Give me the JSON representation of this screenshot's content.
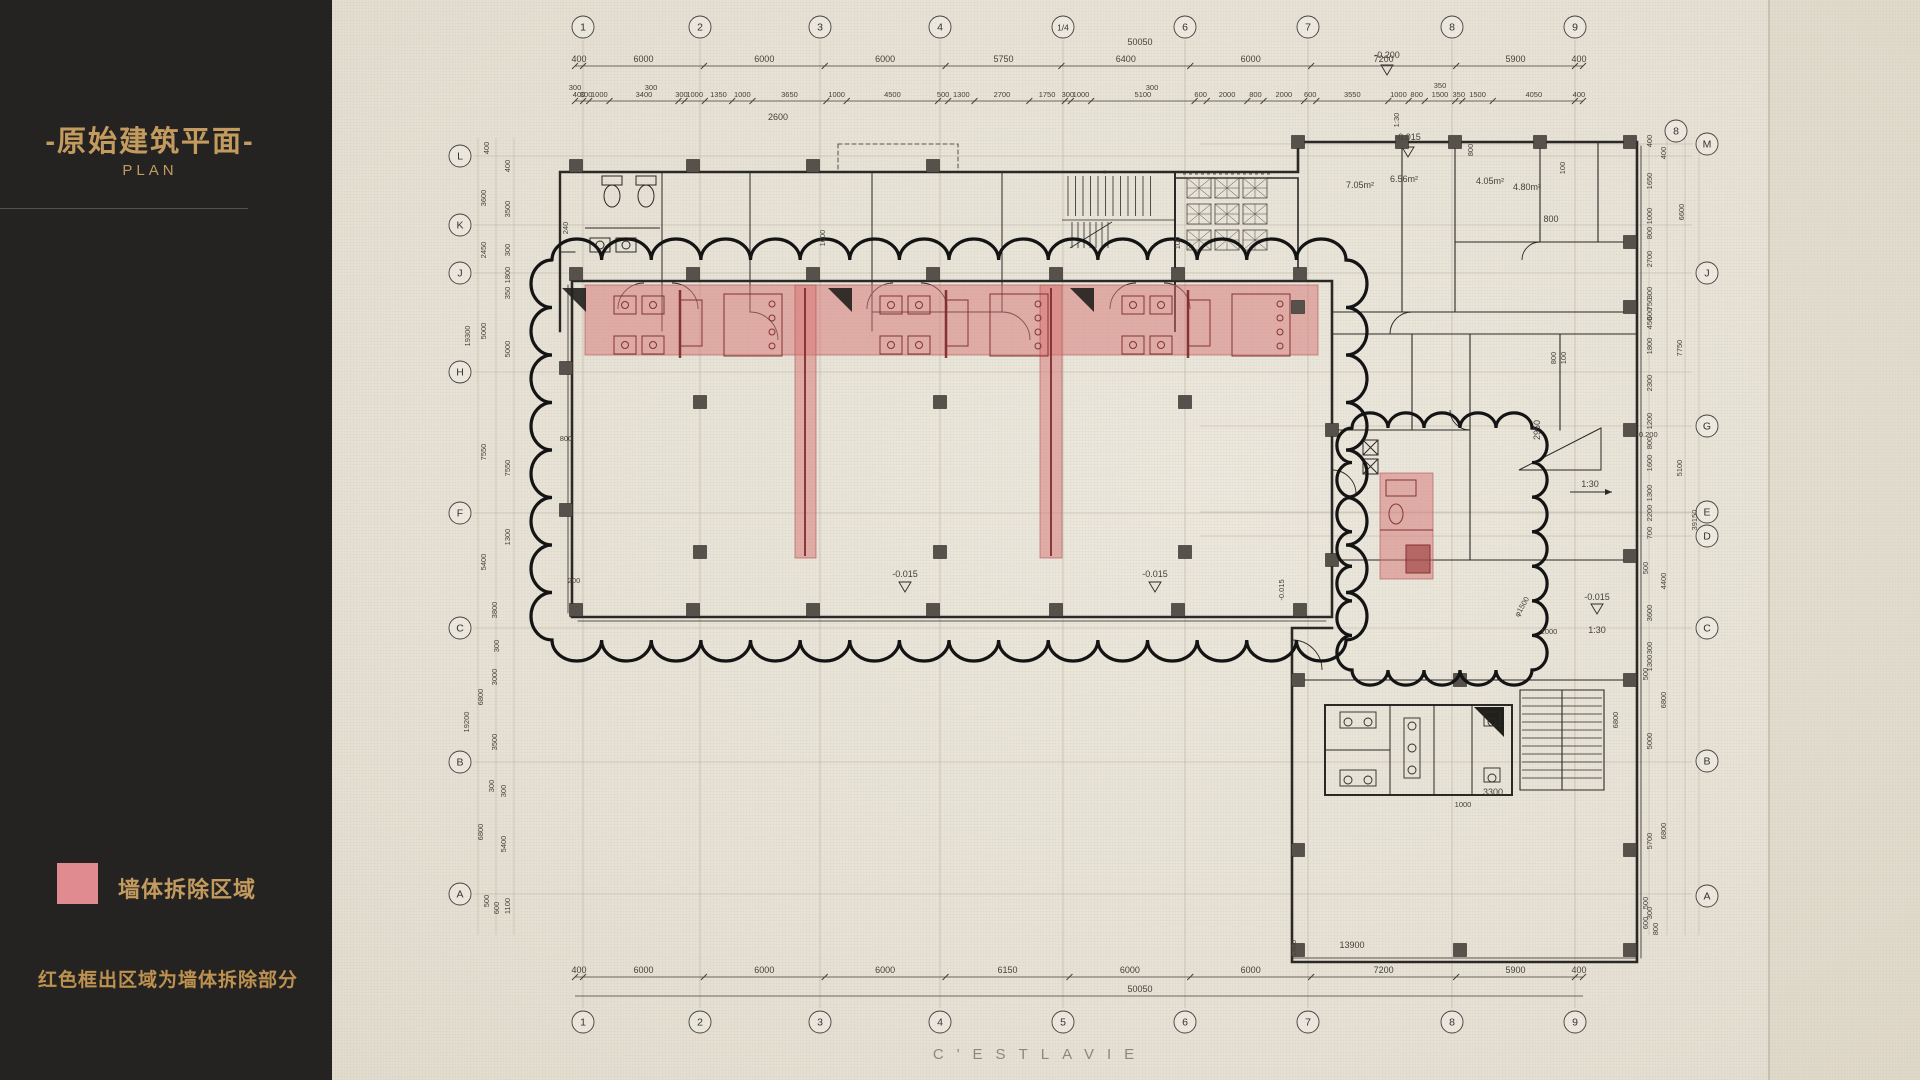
{
  "meta": {
    "paper_bg": "#e9e4d9",
    "sidebar_bg": "#242321",
    "gold": "#c49b5f",
    "ink": "#2b2926",
    "dim_color": "#45413a",
    "red_fill": "#d67676",
    "red_stroke": "#b05252",
    "red_detail": "#7c2626"
  },
  "sidebar": {
    "title": "-原始建筑平面-",
    "subtitle": "PLAN",
    "legend_label": "墙体拆除区域",
    "legend_note": "红色框出区域为墙体拆除部分"
  },
  "watermark": "C'ESTLAVIE",
  "plan": {
    "grid": {
      "top": {
        "y": 27,
        "labels": [
          {
            "t": "1",
            "x": 583
          },
          {
            "t": "2",
            "x": 700
          },
          {
            "t": "3",
            "x": 820
          },
          {
            "t": "4",
            "x": 940
          },
          {
            "t": "1/4",
            "x": 1063
          },
          {
            "t": "6",
            "x": 1185
          },
          {
            "t": "7",
            "x": 1308
          },
          {
            "t": "8",
            "x": 1452
          },
          {
            "t": "9",
            "x": 1575
          }
        ]
      },
      "bottom": {
        "y": 1022,
        "labels": [
          {
            "t": "1",
            "x": 583
          },
          {
            "t": "2",
            "x": 700
          },
          {
            "t": "3",
            "x": 820
          },
          {
            "t": "4",
            "x": 940
          },
          {
            "t": "5",
            "x": 1063
          },
          {
            "t": "6",
            "x": 1185
          },
          {
            "t": "7",
            "x": 1308
          },
          {
            "t": "8",
            "x": 1452
          },
          {
            "t": "9",
            "x": 1575
          }
        ]
      },
      "left": {
        "x": 460,
        "labels": [
          {
            "t": "L",
            "y": 156
          },
          {
            "t": "K",
            "y": 225
          },
          {
            "t": "J",
            "y": 273
          },
          {
            "t": "H",
            "y": 372
          },
          {
            "t": "F",
            "y": 513
          },
          {
            "t": "C",
            "y": 628
          },
          {
            "t": "B",
            "y": 762
          },
          {
            "t": "A",
            "y": 894
          }
        ]
      },
      "right": {
        "x": 1707,
        "labels": [
          {
            "t": "M",
            "y": 144
          },
          {
            "t": "J",
            "y": 273
          },
          {
            "t": "G",
            "y": 426
          },
          {
            "t": "E",
            "y": 512
          },
          {
            "t": "D",
            "y": 536
          },
          {
            "t": "C",
            "y": 628
          },
          {
            "t": "B",
            "y": 761
          },
          {
            "t": "A",
            "y": 896
          }
        ],
        "extra": {
          "t": "8",
          "x": 1676,
          "y": 131
        }
      }
    },
    "dim_rows": {
      "top_main": {
        "y": 62,
        "x0": 575,
        "x1": 1583,
        "values": [
          400,
          6000,
          6000,
          6000,
          5750,
          6400,
          6000,
          7200,
          5900,
          400
        ]
      },
      "top_detail": {
        "y": 97,
        "x0": 575,
        "x1": 1583,
        "values": [
          400,
          300,
          1000,
          3400,
          300,
          1000,
          1350,
          1000,
          3650,
          1000,
          4500,
          500,
          1300,
          2700,
          1750,
          300,
          1000,
          5100,
          600,
          2000,
          800,
          2000,
          600,
          3550,
          1000,
          800,
          1500,
          350,
          1500,
          4050,
          400
        ]
      },
      "bottom_main": {
        "y": 973,
        "x0": 575,
        "x1": 1583,
        "values": [
          400,
          6000,
          6000,
          6000,
          6150,
          6000,
          6000,
          7200,
          5900,
          400
        ]
      }
    },
    "totals": {
      "top": {
        "t": "50050",
        "x": 1140,
        "y": 45
      },
      "bottom": {
        "t": "50050",
        "x": 1140,
        "y": 992
      }
    },
    "side_dims": [
      {
        "x": 489,
        "y": 148,
        "t": "400"
      },
      {
        "x": 510,
        "y": 166,
        "t": "400"
      },
      {
        "x": 486,
        "y": 198,
        "t": "3600"
      },
      {
        "x": 510,
        "y": 209,
        "t": "3500"
      },
      {
        "x": 486,
        "y": 250,
        "t": "2450"
      },
      {
        "x": 510,
        "y": 250,
        "t": "300"
      },
      {
        "x": 510,
        "y": 275,
        "t": "1800"
      },
      {
        "x": 510,
        "y": 293,
        "t": "350"
      },
      {
        "x": 470,
        "y": 336,
        "t": "19300"
      },
      {
        "x": 486,
        "y": 331,
        "t": "5000"
      },
      {
        "x": 510,
        "y": 349,
        "t": "5000"
      },
      {
        "x": 486,
        "y": 452,
        "t": "7550"
      },
      {
        "x": 510,
        "y": 468,
        "t": "7550"
      },
      {
        "x": 510,
        "y": 537,
        "t": "1300"
      },
      {
        "x": 486,
        "y": 562,
        "t": "5400"
      },
      {
        "x": 497,
        "y": 610,
        "t": "3800"
      },
      {
        "x": 499,
        "y": 646,
        "t": "300"
      },
      {
        "x": 497,
        "y": 677,
        "t": "3000"
      },
      {
        "x": 483,
        "y": 697,
        "t": "6800"
      },
      {
        "x": 469,
        "y": 722,
        "t": "19200"
      },
      {
        "x": 497,
        "y": 742,
        "t": "3500"
      },
      {
        "x": 494,
        "y": 786,
        "t": "300"
      },
      {
        "x": 506,
        "y": 791,
        "t": "300"
      },
      {
        "x": 483,
        "y": 832,
        "t": "6800"
      },
      {
        "x": 506,
        "y": 844,
        "t": "5400"
      },
      {
        "x": 489,
        "y": 901,
        "t": "500"
      },
      {
        "x": 499,
        "y": 908,
        "t": "600"
      },
      {
        "x": 510,
        "y": 906,
        "t": "1100"
      },
      {
        "x": 1652,
        "y": 141,
        "t": "400"
      },
      {
        "x": 1666,
        "y": 153,
        "t": "400"
      },
      {
        "x": 1652,
        "y": 181,
        "t": "1650"
      },
      {
        "x": 1684,
        "y": 212,
        "t": "6600"
      },
      {
        "x": 1652,
        "y": 216,
        "t": "1000"
      },
      {
        "x": 1652,
        "y": 233,
        "t": "800"
      },
      {
        "x": 1652,
        "y": 259,
        "t": "2700"
      },
      {
        "x": 1652,
        "y": 293,
        "t": "300"
      },
      {
        "x": 1652,
        "y": 304,
        "t": "750"
      },
      {
        "x": 1652,
        "y": 314,
        "t": "600"
      },
      {
        "x": 1652,
        "y": 323,
        "t": "450"
      },
      {
        "x": 1652,
        "y": 346,
        "t": "1800"
      },
      {
        "x": 1682,
        "y": 348,
        "t": "7750"
      },
      {
        "x": 1652,
        "y": 383,
        "t": "2300"
      },
      {
        "x": 1652,
        "y": 421,
        "t": "1200"
      },
      {
        "x": 1652,
        "y": 443,
        "t": "800"
      },
      {
        "x": 1652,
        "y": 463,
        "t": "1600"
      },
      {
        "x": 1682,
        "y": 468,
        "t": "5100"
      },
      {
        "x": 1652,
        "y": 493,
        "t": "1300"
      },
      {
        "x": 1652,
        "y": 513,
        "t": "2200"
      },
      {
        "x": 1697,
        "y": 520,
        "t": "39150"
      },
      {
        "x": 1652,
        "y": 533,
        "t": "700"
      },
      {
        "x": 1648,
        "y": 568,
        "t": "500"
      },
      {
        "x": 1666,
        "y": 581,
        "t": "4400"
      },
      {
        "x": 1652,
        "y": 613,
        "t": "3600"
      },
      {
        "x": 1652,
        "y": 648,
        "t": "300"
      },
      {
        "x": 1652,
        "y": 663,
        "t": "1300"
      },
      {
        "x": 1648,
        "y": 674,
        "t": "500"
      },
      {
        "x": 1666,
        "y": 700,
        "t": "6800"
      },
      {
        "x": 1618,
        "y": 720,
        "t": "6800"
      },
      {
        "x": 1652,
        "y": 741,
        "t": "5000"
      },
      {
        "x": 1652,
        "y": 841,
        "t": "5700"
      },
      {
        "x": 1666,
        "y": 831,
        "t": "6800"
      },
      {
        "x": 1648,
        "y": 903,
        "t": "500"
      },
      {
        "x": 1652,
        "y": 913,
        "t": "300"
      },
      {
        "x": 1648,
        "y": 923,
        "t": "600"
      },
      {
        "x": 1658,
        "y": 929,
        "t": "800"
      }
    ],
    "annotations": [
      {
        "t": "-0.200",
        "x": 1387,
        "y": 58
      },
      {
        "t": "300",
        "x": 575,
        "y": 90,
        "s": 7.5
      },
      {
        "t": "300",
        "x": 651,
        "y": 90,
        "s": 7.5
      },
      {
        "t": "300",
        "x": 1152,
        "y": 90,
        "s": 7.5
      },
      {
        "t": "350",
        "x": 1440,
        "y": 88,
        "s": 7.5
      },
      {
        "t": "2600",
        "x": 778,
        "y": 120
      },
      {
        "t": "1000",
        "x": 825,
        "y": 238,
        "r": -90,
        "s": 7.5
      },
      {
        "t": "240",
        "x": 568,
        "y": 228,
        "r": -90,
        "s": 7.5
      },
      {
        "t": "1:30",
        "x": 1399,
        "y": 120,
        "r": -90,
        "s": 7.5
      },
      {
        "t": "-0.015",
        "x": 1408,
        "y": 140
      },
      {
        "t": "7.05m²",
        "x": 1360,
        "y": 188
      },
      {
        "t": "6.56m²",
        "x": 1404,
        "y": 182
      },
      {
        "t": "4.05m²",
        "x": 1490,
        "y": 184
      },
      {
        "t": "4.80m²",
        "x": 1527,
        "y": 190
      },
      {
        "t": "800",
        "x": 1473,
        "y": 150,
        "r": -90,
        "s": 7.5
      },
      {
        "t": "100",
        "x": 1565,
        "y": 168,
        "r": -90,
        "s": 7.5
      },
      {
        "t": "800",
        "x": 1551,
        "y": 222
      },
      {
        "t": "100",
        "x": 1180,
        "y": 243,
        "r": -90,
        "s": 7.5
      },
      {
        "t": "800",
        "x": 1556,
        "y": 358,
        "r": -90,
        "s": 7.5
      },
      {
        "t": "100",
        "x": 1566,
        "y": 358,
        "r": -90,
        "s": 7.5
      },
      {
        "t": "2950",
        "x": 1540,
        "y": 430,
        "r": -90
      },
      {
        "t": "-0.200",
        "x": 1647,
        "y": 437,
        "s": 7.5
      },
      {
        "t": "1:30",
        "x": 1590,
        "y": 487
      },
      {
        "t": "φ1500",
        "x": 1524,
        "y": 608,
        "r": -60,
        "s": 7.5
      },
      {
        "t": "1000",
        "x": 1549,
        "y": 634,
        "s": 7.5
      },
      {
        "t": "-0.015",
        "x": 1597,
        "y": 600
      },
      {
        "t": "1:30",
        "x": 1597,
        "y": 633
      },
      {
        "t": "200",
        "x": 574,
        "y": 583,
        "s": 7.5
      },
      {
        "t": "-0.015",
        "x": 905,
        "y": 577
      },
      {
        "t": "-0.015",
        "x": 1155,
        "y": 577
      },
      {
        "t": "-0.015",
        "x": 1284,
        "y": 590,
        "r": -90,
        "s": 7.5
      },
      {
        "t": "800",
        "x": 566,
        "y": 441,
        "s": 7.5
      },
      {
        "t": "3300",
        "x": 1493,
        "y": 795
      },
      {
        "t": "1000",
        "x": 1463,
        "y": 807,
        "s": 7.5
      },
      {
        "t": "13900",
        "x": 1352,
        "y": 948
      },
      {
        "t": "1400",
        "x": 1296,
        "y": 948,
        "r": -90,
        "s": 7.5
      }
    ],
    "demolition_zones": [
      {
        "x": 585,
        "y": 285,
        "w": 733,
        "h": 70
      },
      {
        "x": 795,
        "y": 285,
        "w": 21,
        "h": 273
      },
      {
        "x": 1040,
        "y": 285,
        "w": 22,
        "h": 273
      },
      {
        "x": 1380,
        "y": 473,
        "w": 53,
        "h": 106
      }
    ]
  }
}
